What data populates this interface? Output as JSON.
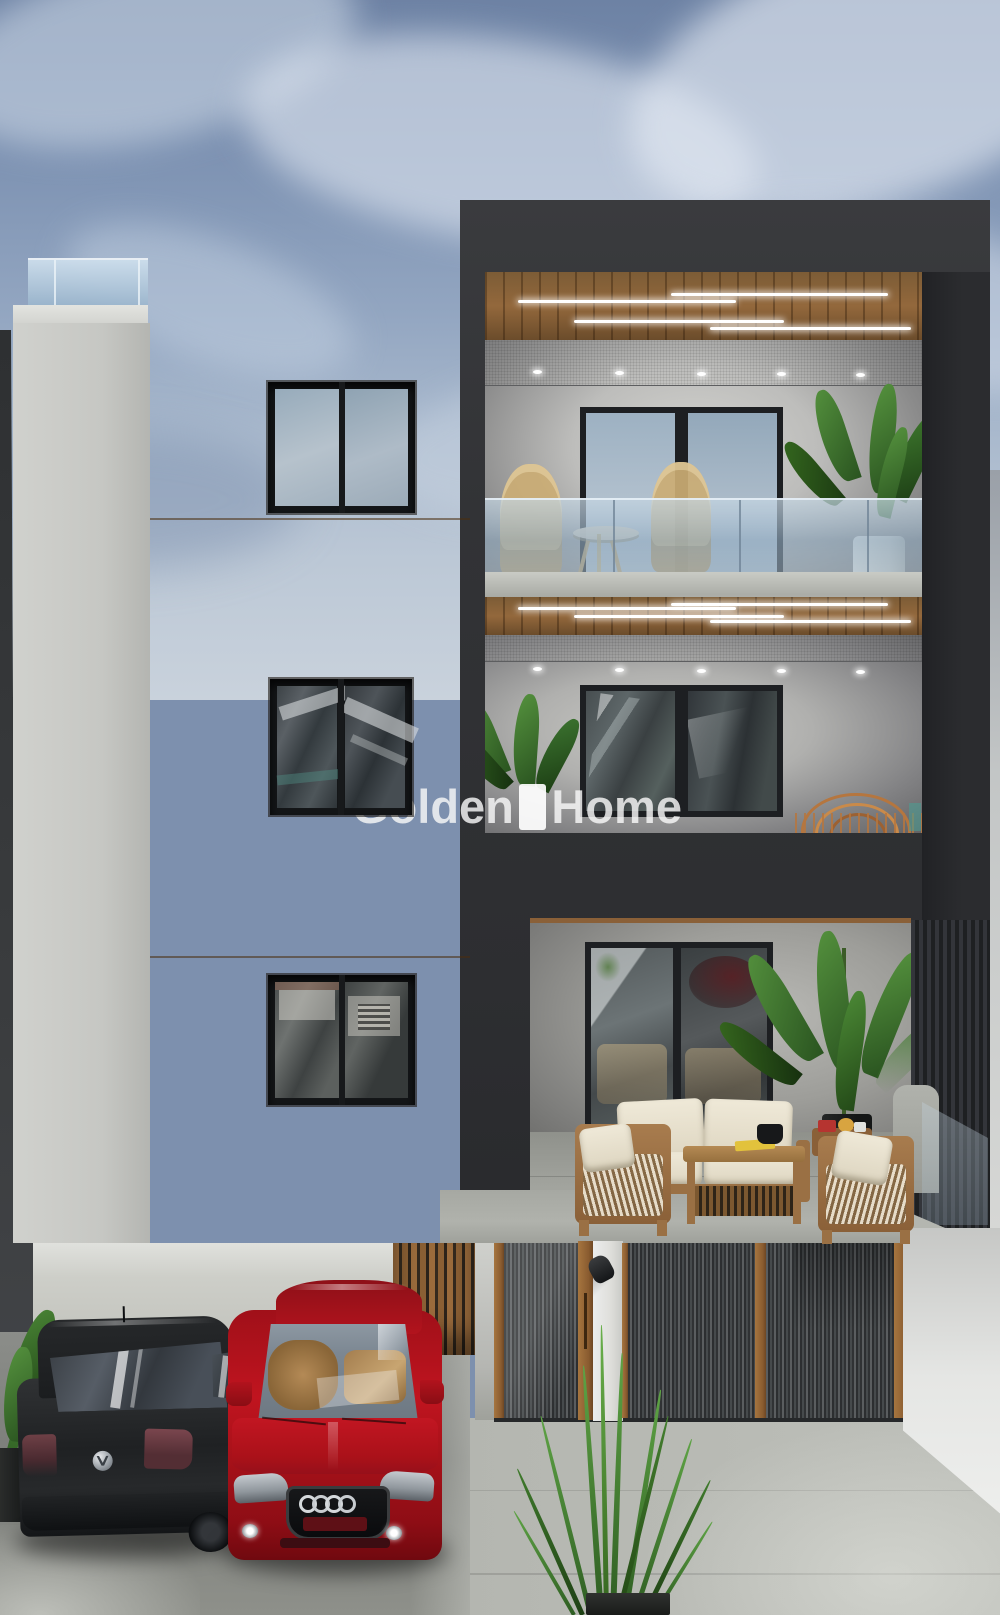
{
  "watermark": {
    "brand_left": "Golden",
    "brand_right": "Home"
  },
  "palette": {
    "sky_base": "#7d90ae",
    "sky_cloud": "#ccd5e2",
    "wood_facade": "#a87a42",
    "dark_facade": "#323336",
    "left_wall": "#c9cac6",
    "concrete_drive": "#b2b4ae",
    "glass_rail": "#9bb4c8",
    "led_light": "#ffffff",
    "sofa_cushion": "#ece6d5",
    "plant_green": "#417a30",
    "car_black": "#26282a",
    "car_red": "#b01420",
    "fence_metal": "#3c3e40",
    "fence_wood_post": "#9c6c3e"
  },
  "icons": {
    "vw_badge": "vw-badge-icon",
    "audi_rings": "audi-rings-icon"
  }
}
